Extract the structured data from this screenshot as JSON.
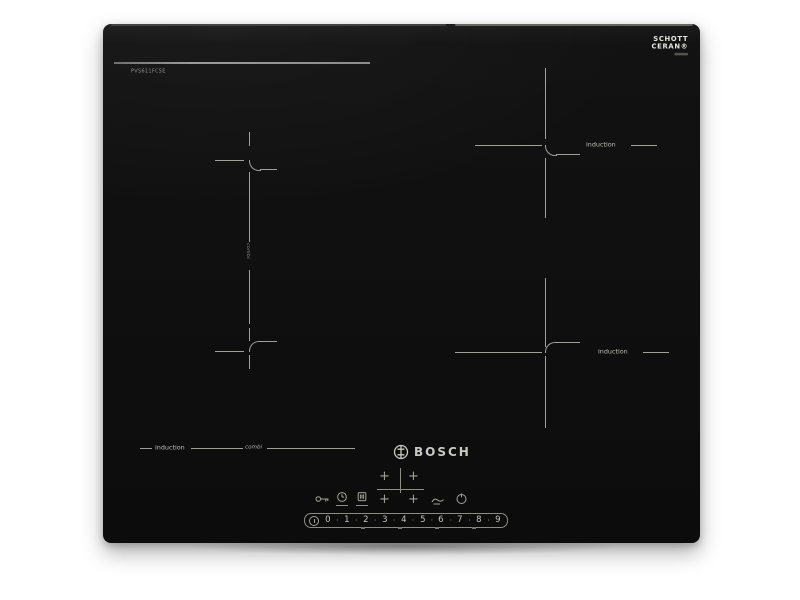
{
  "product": {
    "brand_logo": "BOSCH",
    "model_number": "PVS611FC5E",
    "glass_brand": {
      "line1": "SCHOTT",
      "line2": "CERAN®"
    }
  },
  "zones": {
    "right_top_label": "induction",
    "right_bottom_label": "induction",
    "front_left_label": "induction",
    "front_script_label": "combi",
    "bridge_label": "combi"
  },
  "controls": {
    "zone_selector_plus": "+",
    "power_levels": [
      "0",
      "1",
      "2",
      "3",
      "4",
      "5",
      "6",
      "7",
      "8",
      "9"
    ],
    "separator": "·"
  },
  "colors": {
    "background": "#ffffff",
    "glass": "#101010",
    "markings": "#bab9b4",
    "label_text": "#bdbdb8"
  }
}
